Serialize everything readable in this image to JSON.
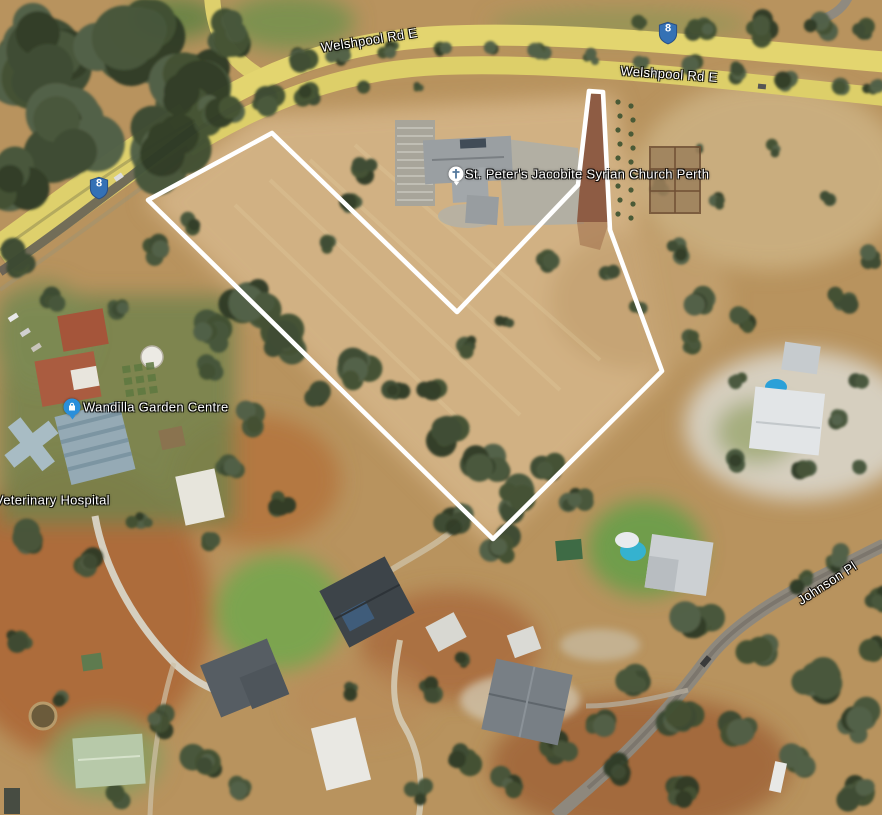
{
  "map": {
    "view": "satellite",
    "road_labels": [
      {
        "text": "Welshpool Rd E"
      },
      {
        "text": "Welshpool Rd E"
      },
      {
        "text": "Johnson Pl"
      }
    ],
    "route_shields": [
      {
        "number": "8"
      },
      {
        "number": "8"
      }
    ],
    "pois": [
      {
        "name": "St. Peter's Jacobite Syrian Church Perth",
        "icon": "church-cross-icon"
      },
      {
        "name": "Wandilla Garden Centre",
        "icon": "shopping-bag-icon"
      },
      {
        "name": "Veterinary Hospital",
        "icon": "none"
      }
    ],
    "boundary": {
      "points": "589,91 578,185 457,312 272,133 148,200 493,539 662,371 610,230 603,92",
      "stroke": "#ffffff"
    },
    "colors": {
      "route_shield_blue": "#3471b5",
      "road_overlay_yellow": "#e2d26b",
      "boundary_white": "#ffffff",
      "poi_icon_blue": "#2a8fdb",
      "dry_paddock_tan": "#d1b183",
      "tree_green": "#3a4930"
    }
  }
}
